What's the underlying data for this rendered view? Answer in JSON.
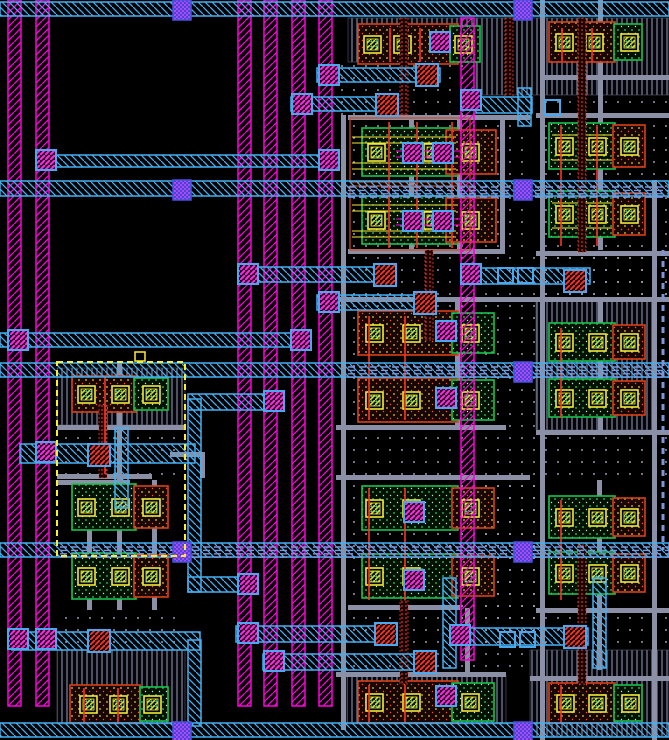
{
  "app": {
    "name": "ic-layout-viewer",
    "view": "layout-canvas",
    "selection_present": true
  },
  "canvas": {
    "width": 669,
    "height": 740,
    "background": "#000000"
  },
  "palette": {
    "metal2_magenta": "#ff00dd",
    "metal1_cyan": "#45b0f2",
    "metal3_bus_blue": "#8095d6",
    "via_bright_magenta": "#ff2be0",
    "via_frame_blue": "#49a8ee",
    "via2_purple_fill": "#3b49dd",
    "via2_purple_hatch": "#b944ee",
    "poly_red": "#ff3326",
    "poly_orange": "#e23c28",
    "diff_green": "#19c24f",
    "diff_red_orange": "#d84018",
    "contact_yellow": "#f2ea3c",
    "contact_hatch": "#cde23a",
    "contact_teal_dot": "#3ad0c0",
    "rail_gray": "#8b90a6",
    "well_dot": "#c2c6da",
    "selection_yellow": "#ffee2e"
  },
  "layout": {
    "vhatch_regions": [
      [
        348,
        18,
        200,
        44
      ],
      [
        476,
        18,
        193,
        77
      ],
      [
        57,
        368,
        128,
        57
      ],
      [
        536,
        300,
        120,
        130
      ],
      [
        347,
        675,
        159,
        49
      ],
      [
        530,
        650,
        139,
        86
      ],
      [
        57,
        650,
        128,
        74
      ]
    ],
    "dot_regions": [
      [
        336,
        62,
        140,
        53
      ],
      [
        545,
        95,
        124,
        30
      ],
      [
        336,
        247,
        333,
        50
      ],
      [
        336,
        300,
        200,
        128
      ],
      [
        336,
        430,
        333,
        45
      ],
      [
        336,
        475,
        200,
        133
      ],
      [
        336,
        608,
        200,
        64
      ],
      [
        536,
        115,
        133,
        132
      ],
      [
        536,
        247,
        133,
        53
      ],
      [
        57,
        425,
        128,
        50
      ],
      [
        57,
        608,
        128,
        42
      ],
      [
        440,
        608,
        229,
        42
      ],
      [
        348,
        115,
        182,
        135
      ],
      [
        440,
        475,
        100,
        133
      ]
    ],
    "gray_h_rails": [
      [
        348,
        115,
        182
      ],
      [
        536,
        113,
        133
      ],
      [
        545,
        75,
        124
      ],
      [
        348,
        249,
        157
      ],
      [
        536,
        251,
        133
      ],
      [
        336,
        297,
        333
      ],
      [
        57,
        425,
        128
      ],
      [
        57,
        474,
        95
      ],
      [
        57,
        480,
        73
      ],
      [
        336,
        425,
        170
      ],
      [
        536,
        430,
        133
      ],
      [
        336,
        475,
        194
      ],
      [
        348,
        605,
        112
      ],
      [
        536,
        608,
        133
      ],
      [
        336,
        672,
        170
      ],
      [
        530,
        676,
        139
      ],
      [
        170,
        452,
        35
      ]
    ],
    "gray_v_rails": [
      [
        341,
        115,
        615
      ],
      [
        500,
        115,
        137
      ],
      [
        457,
        120,
        130
      ],
      [
        409,
        120,
        130
      ],
      [
        540,
        0,
        740
      ],
      [
        652,
        180,
        560
      ],
      [
        598,
        0,
        250
      ],
      [
        598,
        300,
        130
      ],
      [
        455,
        300,
        128
      ],
      [
        87,
        480,
        130
      ],
      [
        117,
        362,
        248
      ],
      [
        152,
        480,
        130
      ],
      [
        200,
        452,
        26
      ],
      [
        597,
        480,
        190
      ],
      [
        465,
        608,
        64
      ]
    ],
    "device_rows": [
      {
        "x": 358,
        "y": 24,
        "w": 100,
        "h": 40,
        "kind": "red",
        "contacts": [
          364,
          394
        ],
        "tap": {
          "x": 450,
          "w": 30,
          "c": 455,
          "kind": "green"
        }
      },
      {
        "x": 549,
        "y": 22,
        "w": 66,
        "h": 40,
        "kind": "red",
        "contacts": [
          556,
          586
        ],
        "tap": {
          "x": 614,
          "w": 28,
          "c": 621,
          "kind": "green"
        }
      },
      {
        "x": 362,
        "y": 128,
        "w": 96,
        "h": 48,
        "kind": "green",
        "contacts": [
          368,
          424
        ],
        "tap": {
          "x": 446,
          "w": 50,
          "c": 462,
          "kind": "red"
        }
      },
      {
        "x": 362,
        "y": 196,
        "w": 96,
        "h": 48,
        "kind": "green",
        "contacts": [
          368,
          424
        ],
        "tap": {
          "x": 446,
          "w": 50,
          "c": 462,
          "kind": "red"
        }
      },
      {
        "x": 549,
        "y": 123,
        "w": 66,
        "h": 46,
        "kind": "green",
        "contacts": [
          556,
          589
        ],
        "tap": {
          "x": 613,
          "w": 32,
          "c": 621,
          "kind": "red"
        }
      },
      {
        "x": 549,
        "y": 191,
        "w": 66,
        "h": 46,
        "kind": "green",
        "contacts": [
          556,
          589
        ],
        "tap": {
          "x": 613,
          "w": 32,
          "c": 621,
          "kind": "red"
        }
      },
      {
        "x": 358,
        "y": 311,
        "w": 100,
        "h": 44,
        "kind": "red",
        "contacts": [
          366,
          403
        ],
        "tap": {
          "x": 452,
          "w": 42,
          "c": 462,
          "kind": "green"
        }
      },
      {
        "x": 358,
        "y": 378,
        "w": 100,
        "h": 44,
        "kind": "red",
        "contacts": [
          366,
          403
        ],
        "tap": {
          "x": 452,
          "w": 42,
          "c": 462,
          "kind": "green"
        }
      },
      {
        "x": 549,
        "y": 323,
        "w": 66,
        "h": 38,
        "kind": "green",
        "contacts": [
          556,
          589
        ],
        "tap": {
          "x": 613,
          "w": 32,
          "c": 621,
          "kind": "red"
        }
      },
      {
        "x": 549,
        "y": 379,
        "w": 66,
        "h": 38,
        "kind": "green",
        "contacts": [
          556,
          589
        ],
        "tap": {
          "x": 613,
          "w": 32,
          "c": 621,
          "kind": "red"
        }
      },
      {
        "x": 362,
        "y": 486,
        "w": 96,
        "h": 44,
        "kind": "green",
        "contacts": [
          366,
          403
        ],
        "tap": {
          "x": 452,
          "w": 42,
          "c": 462,
          "kind": "red"
        }
      },
      {
        "x": 362,
        "y": 554,
        "w": 96,
        "h": 44,
        "kind": "green",
        "contacts": [
          366,
          403
        ],
        "tap": {
          "x": 452,
          "w": 42,
          "c": 462,
          "kind": "red"
        }
      },
      {
        "x": 549,
        "y": 496,
        "w": 66,
        "h": 42,
        "kind": "green",
        "contacts": [
          556,
          589
        ],
        "tap": {
          "x": 613,
          "w": 32,
          "c": 621,
          "kind": "red"
        }
      },
      {
        "x": 549,
        "y": 552,
        "w": 66,
        "h": 42,
        "kind": "green",
        "contacts": [
          556,
          589
        ],
        "tap": {
          "x": 613,
          "w": 32,
          "c": 621,
          "kind": "red"
        }
      },
      {
        "x": 358,
        "y": 681,
        "w": 100,
        "h": 42,
        "kind": "red",
        "contacts": [
          366,
          403
        ],
        "tap": {
          "x": 452,
          "w": 42,
          "c": 462,
          "kind": "green"
        }
      },
      {
        "x": 549,
        "y": 683,
        "w": 66,
        "h": 40,
        "kind": "red",
        "contacts": [
          557,
          589
        ],
        "tap": {
          "x": 614,
          "w": 28,
          "c": 622,
          "kind": "green"
        }
      },
      {
        "x": 72,
        "y": 376,
        "w": 64,
        "h": 36,
        "kind": "red",
        "contacts": [
          78,
          112
        ],
        "tap": {
          "x": 134,
          "w": 34,
          "c": 143,
          "kind": "green"
        }
      },
      {
        "x": 72,
        "y": 484,
        "w": 64,
        "h": 46,
        "kind": "green",
        "contacts": [
          78,
          112
        ],
        "tap": {
          "x": 134,
          "w": 34,
          "c": 143,
          "kind": "red"
        }
      },
      {
        "x": 72,
        "y": 553,
        "w": 64,
        "h": 46,
        "kind": "green",
        "contacts": [
          78,
          112
        ],
        "tap": {
          "x": 134,
          "w": 34,
          "c": 143,
          "kind": "red"
        }
      },
      {
        "x": 70,
        "y": 685,
        "w": 70,
        "h": 38,
        "kind": "red",
        "contacts": [
          80,
          110
        ],
        "tap": {
          "x": 140,
          "w": 28,
          "c": 144,
          "kind": "green"
        }
      }
    ],
    "orange_outline_boxes": [
      [
        350,
        118,
        120,
        64
      ],
      [
        350,
        186,
        120,
        64
      ]
    ],
    "yellow_texture_lines": [
      [
        352,
        137,
        104
      ],
      [
        352,
        143,
        104
      ],
      [
        352,
        163,
        104
      ],
      [
        352,
        169,
        104
      ],
      [
        352,
        205,
        104
      ],
      [
        352,
        211,
        104
      ],
      [
        352,
        231,
        104
      ],
      [
        352,
        237,
        104
      ],
      [
        552,
        135,
        60
      ],
      [
        552,
        160,
        60
      ],
      [
        552,
        203,
        60
      ],
      [
        552,
        228,
        60
      ]
    ],
    "magenta_texture_lines": [
      [
        396,
        151,
        64
      ],
      [
        396,
        157,
        64
      ],
      [
        396,
        219,
        64
      ],
      [
        396,
        225,
        64
      ]
    ],
    "poly_columns": [
      [
        400,
        18,
        97
      ],
      [
        505,
        18,
        79
      ],
      [
        578,
        18,
        234
      ],
      [
        425,
        250,
        90
      ],
      [
        99,
        405,
        73
      ],
      [
        400,
        600,
        84
      ],
      [
        578,
        545,
        139
      ]
    ],
    "poly_gate_lines": [
      [
        389,
        122,
        248
      ],
      [
        417,
        122,
        248
      ],
      [
        452,
        122,
        248
      ],
      [
        561,
        125,
        246
      ],
      [
        597,
        125,
        246
      ],
      [
        369,
        316,
        420
      ],
      [
        405,
        316,
        420
      ],
      [
        561,
        328,
        418
      ],
      [
        105,
        376,
        474
      ],
      [
        369,
        488,
        600
      ],
      [
        405,
        488,
        600
      ],
      [
        561,
        500,
        600
      ],
      [
        369,
        685,
        724
      ],
      [
        405,
        685,
        724
      ],
      [
        561,
        685,
        724
      ],
      [
        84,
        688,
        724
      ],
      [
        118,
        688,
        724
      ],
      [
        390,
        28,
        62
      ],
      [
        420,
        28,
        62
      ],
      [
        562,
        28,
        62
      ],
      [
        592,
        28,
        62
      ]
    ],
    "metal2_stripes": [
      [
        8,
        0,
        706
      ],
      [
        36,
        0,
        706
      ],
      [
        238,
        0,
        706
      ],
      [
        264,
        0,
        706
      ],
      [
        292,
        0,
        706
      ],
      [
        319,
        0,
        706
      ],
      [
        461,
        18,
        642
      ]
    ],
    "metal1_wires": [
      [
        0,
        2,
        669,
        14
      ],
      [
        36,
        155,
        297,
        12
      ],
      [
        0,
        181,
        669,
        15
      ],
      [
        317,
        68,
        123,
        14
      ],
      [
        291,
        97,
        106,
        14
      ],
      [
        476,
        97,
        56,
        16
      ],
      [
        238,
        267,
        157,
        15
      ],
      [
        317,
        295,
        119,
        15
      ],
      [
        476,
        268,
        114,
        16
      ],
      [
        0,
        333,
        305,
        14
      ],
      [
        0,
        363,
        669,
        14
      ],
      [
        188,
        394,
        90,
        16
      ],
      [
        20,
        444,
        175,
        19
      ],
      [
        0,
        543,
        669,
        14
      ],
      [
        188,
        577,
        64,
        15
      ],
      [
        236,
        626,
        160,
        16
      ],
      [
        12,
        632,
        188,
        18
      ],
      [
        263,
        654,
        173,
        16
      ],
      [
        450,
        628,
        138,
        17
      ],
      [
        0,
        723,
        669,
        14
      ]
    ],
    "metal1_vbars": [
      [
        188,
        399,
        13,
        193
      ],
      [
        188,
        640,
        13,
        86
      ],
      [
        115,
        428,
        13,
        80
      ],
      [
        518,
        88,
        13,
        38
      ],
      [
        443,
        578,
        13,
        90
      ],
      [
        593,
        578,
        13,
        90
      ]
    ],
    "bus_bands": [
      [
        348,
        185,
        321
      ],
      [
        348,
        365,
        321
      ],
      [
        60,
        545,
        609
      ]
    ],
    "vdash_columns": [
      [
        663,
        250,
        300
      ]
    ],
    "via1_magenta": [
      [
        36,
        150
      ],
      [
        319,
        150
      ],
      [
        8,
        330
      ],
      [
        291,
        330
      ],
      [
        319,
        65
      ],
      [
        292,
        94
      ],
      [
        238,
        264
      ],
      [
        319,
        292
      ],
      [
        264,
        391
      ],
      [
        36,
        442
      ],
      [
        8,
        629
      ],
      [
        36,
        629
      ],
      [
        238,
        574
      ],
      [
        238,
        623
      ],
      [
        264,
        651
      ],
      [
        461,
        90
      ],
      [
        461,
        264
      ],
      [
        450,
        625
      ],
      [
        430,
        32
      ],
      [
        403,
        143
      ],
      [
        433,
        143
      ],
      [
        403,
        211
      ],
      [
        433,
        211
      ],
      [
        436,
        321
      ],
      [
        436,
        388
      ],
      [
        404,
        502
      ],
      [
        404,
        570
      ],
      [
        436,
        686
      ]
    ],
    "via2_purple": [
      [
        173,
        0
      ],
      [
        514,
        0
      ],
      [
        173,
        180
      ],
      [
        514,
        180
      ],
      [
        514,
        362
      ],
      [
        173,
        542
      ],
      [
        514,
        542
      ],
      [
        173,
        722
      ],
      [
        514,
        722
      ]
    ],
    "poly_contacts_red": [
      [
        416,
        64
      ],
      [
        376,
        94
      ],
      [
        374,
        264
      ],
      [
        414,
        292
      ],
      [
        564,
        270
      ],
      [
        88,
        444
      ],
      [
        88,
        630
      ],
      [
        375,
        623
      ],
      [
        414,
        651
      ],
      [
        564,
        626
      ]
    ],
    "m1_pads": [
      [
        498,
        268
      ],
      [
        518,
        268
      ],
      [
        500,
        632
      ],
      [
        520,
        632
      ],
      [
        545,
        100
      ]
    ],
    "selection_box": {
      "x": 57,
      "y": 362,
      "w": 128,
      "h": 194
    },
    "selection_marker": {
      "x": 135,
      "y": 352,
      "w": 10,
      "h": 9
    }
  }
}
